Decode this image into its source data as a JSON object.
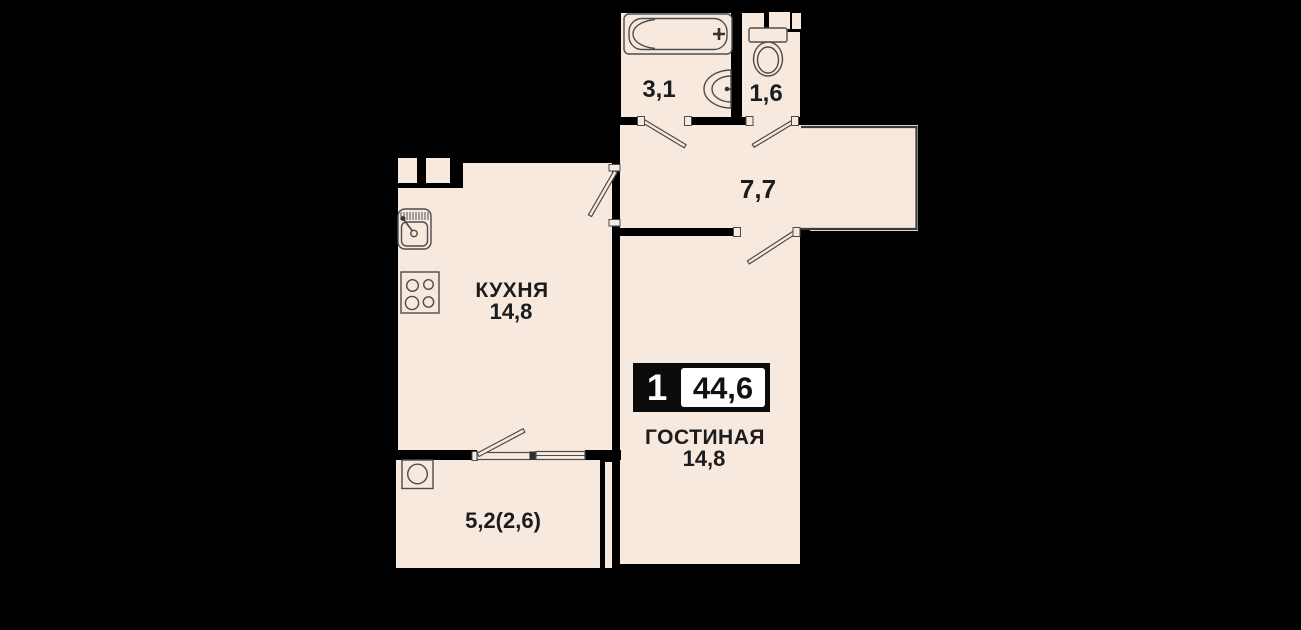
{
  "badge": {
    "rooms_count": "1",
    "total_area": "44,6"
  },
  "rooms": {
    "bathroom": {
      "area": "3,1",
      "icons": [
        "bathtub-icon",
        "washbasin-icon"
      ]
    },
    "toilet": {
      "area": "1,6",
      "icons": [
        "toilet-icon"
      ]
    },
    "hallway": {
      "area": "7,7"
    },
    "kitchen": {
      "name": "КУХНЯ",
      "area": "14,8",
      "icons": [
        "kitchen-sink-icon",
        "stove-icon"
      ]
    },
    "living_room": {
      "name": "ГОСТИНАЯ",
      "area": "14,8"
    },
    "balcony": {
      "area": "5,2(2,6)",
      "icons": [
        "washing-machine-icon"
      ]
    }
  },
  "colors": {
    "background": "#000000",
    "floor": "#f8e9df",
    "wall": "#000000",
    "line": "#4c4c4c",
    "text": "#1c1c1c",
    "badge_bg": "#0b0b0b",
    "badge_value_bg": "#ffffff"
  }
}
